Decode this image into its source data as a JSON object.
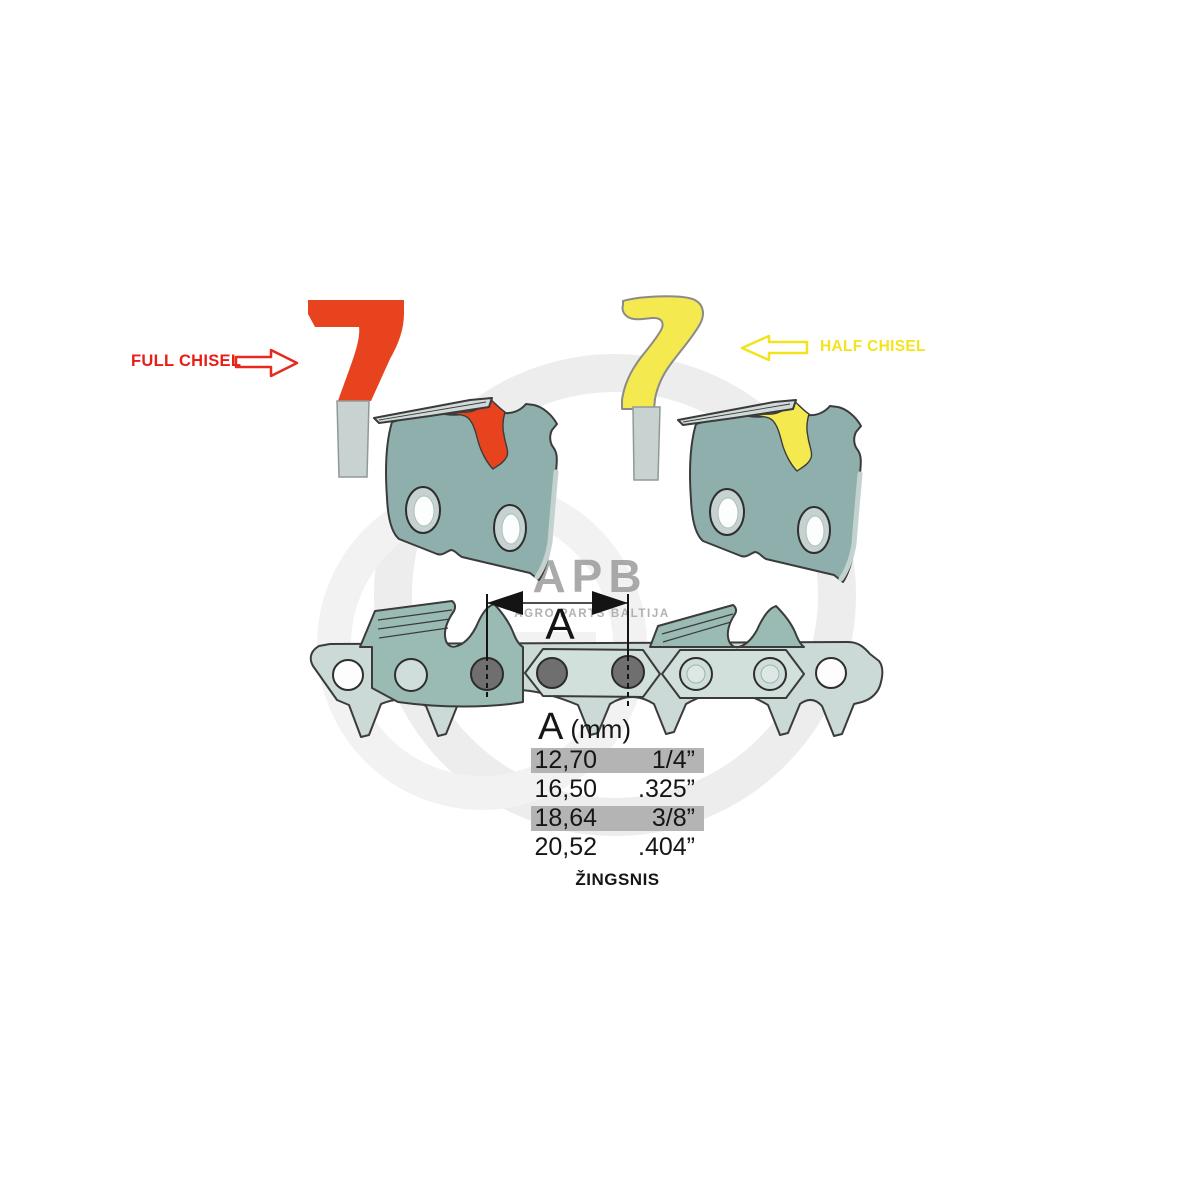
{
  "labels": {
    "full_chisel": "FULL CHISEL",
    "half_chisel": "HALF CHISEL"
  },
  "dimension": {
    "letter": "A"
  },
  "watermark": {
    "brand": "APB",
    "subtitle": "AGRO PARTS BALTIJA"
  },
  "table": {
    "header": {
      "letter": "A",
      "unit": "(mm)"
    },
    "rows": [
      {
        "mm": "12,70",
        "inch": "1/4”",
        "highlighted": true
      },
      {
        "mm": "16,50",
        "inch": ".325”",
        "highlighted": false
      },
      {
        "mm": "18,64",
        "inch": "3/8”",
        "highlighted": true
      },
      {
        "mm": "20,52",
        "inch": ".404”",
        "highlighted": false
      }
    ],
    "caption": "ŽINGSNIS"
  },
  "colors": {
    "full_chisel_red": "#e8431f",
    "half_chisel_yellow": "#f4e94e",
    "link_teal": "#8fafac",
    "chain_band": "#cbdad6",
    "table_highlight": "#b4b4b4",
    "watermark_gray": "#ededed"
  }
}
